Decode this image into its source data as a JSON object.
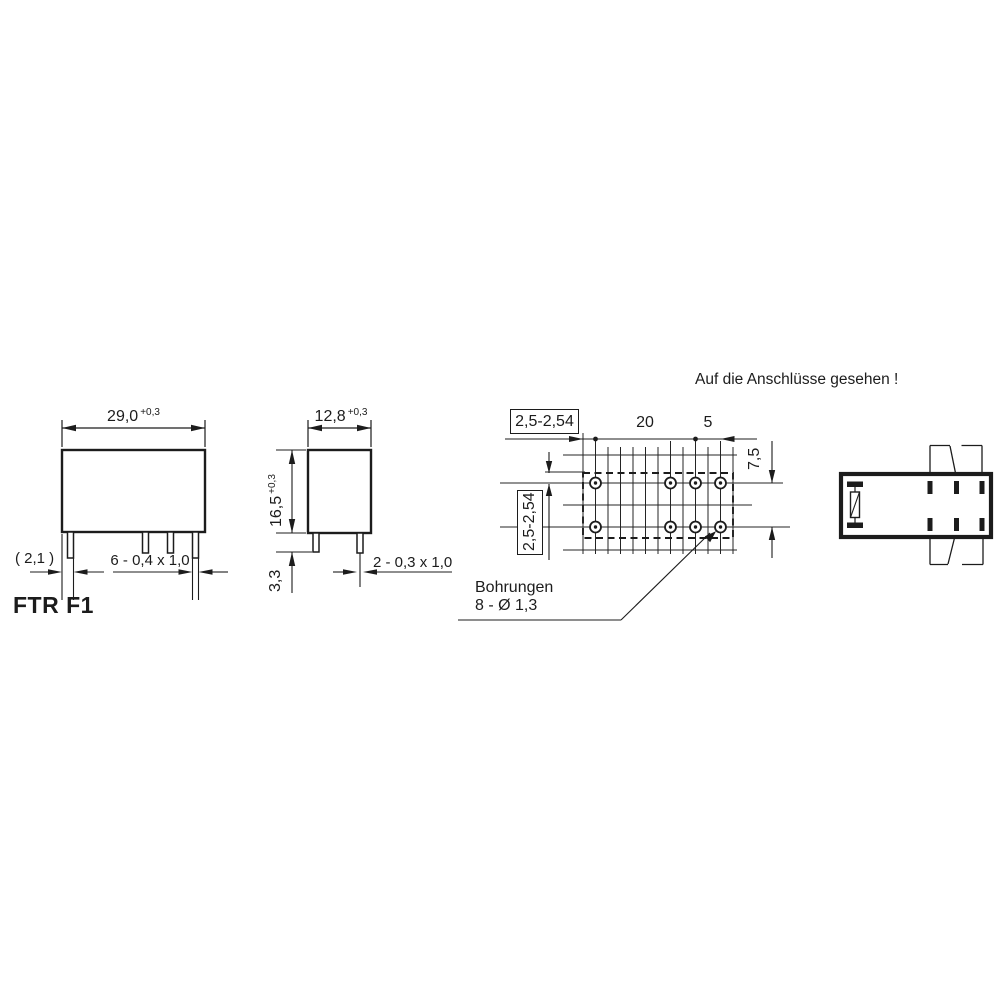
{
  "title": "Auf die Anschlüsse gesehen !",
  "part_label": "FTR F1",
  "front_view": {
    "width_value": "29,0",
    "width_tolerance": "+0,3",
    "edge_offset": "( 2,1 )",
    "pins_spec": "6 - 0,4 x 1,0"
  },
  "side_view": {
    "width_value": "12,8",
    "width_tolerance": "+0,3",
    "height_value": "16,5",
    "height_tolerance": "+0,3",
    "pin_length": "3,3",
    "pins_spec": "2 - 0,3 x 1,0"
  },
  "pcb_view": {
    "grid_pitch_horizontal": "2,5-2,54",
    "grid_pitch_vertical": "2,5-2,54",
    "hole_span": "20",
    "hole_end_span": "5",
    "row_spacing": "7,5",
    "drill_note_line1": "Bohrungen",
    "drill_note_line2": "8 - Ø 1,3"
  },
  "colors": {
    "ink": "#1c1c1c",
    "background": "#ffffff"
  }
}
